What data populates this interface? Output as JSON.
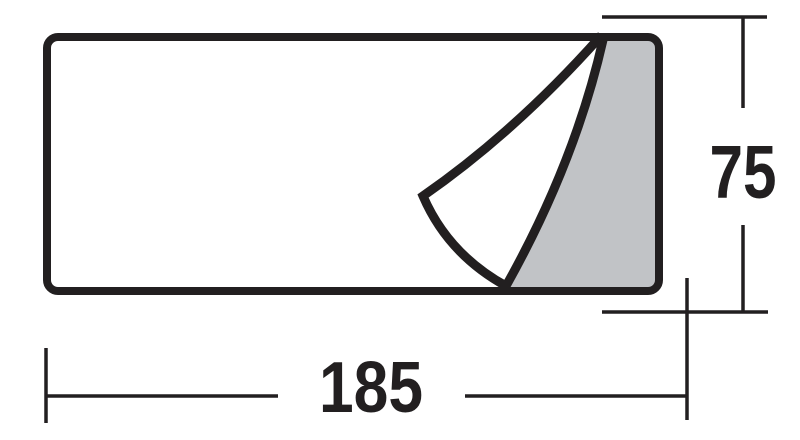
{
  "drawing": {
    "title": "Dimensioned outline drawing of a rectangular mat with its top-right corner folded back",
    "shape": "rounded-rectangle",
    "fold_description": "corner flap folded toward bottom edge revealing shaded underside"
  },
  "dimensions": {
    "width": {
      "value": "185",
      "orientation": "horizontal",
      "position": "bottom"
    },
    "height": {
      "value": "75",
      "orientation": "vertical",
      "position": "right"
    }
  },
  "colors": {
    "line": "#221f20",
    "shaded_fill": "#c1c3c6",
    "background": "#ffffff",
    "text": "#221f20"
  }
}
